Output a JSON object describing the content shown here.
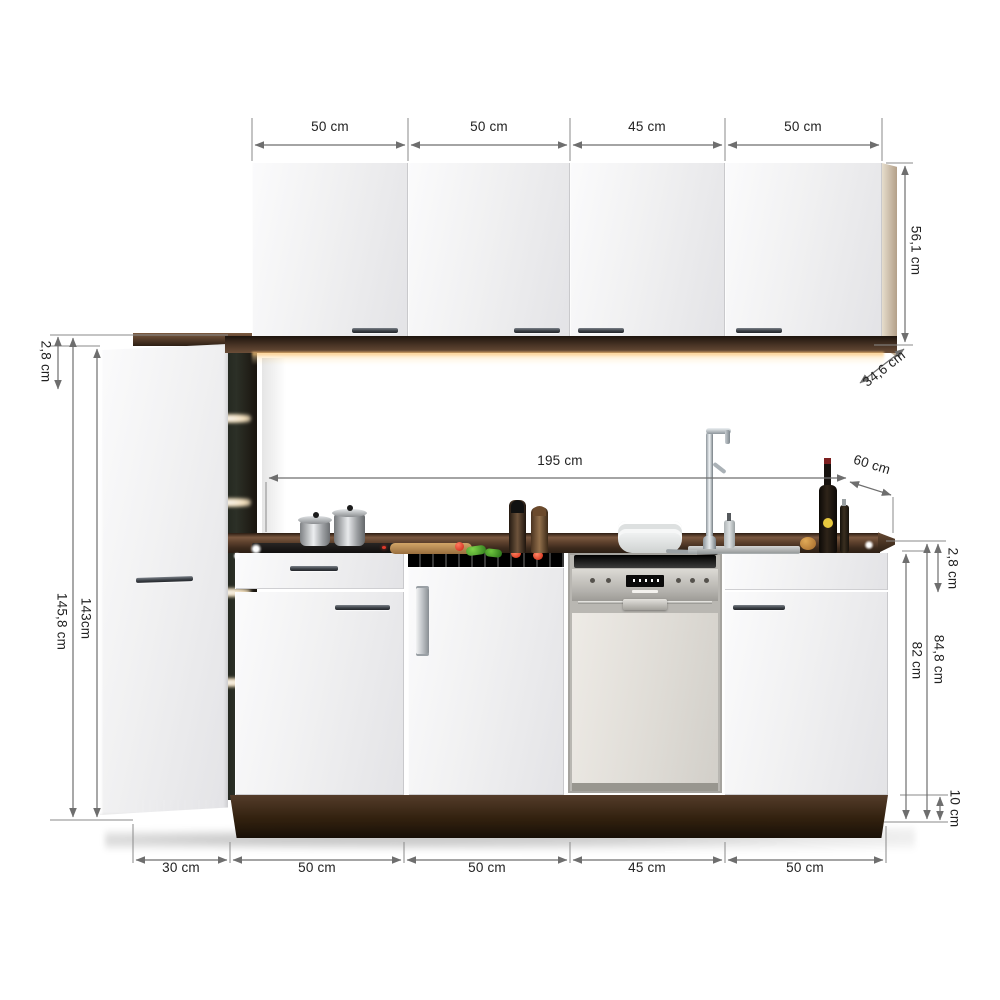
{
  "diagram": {
    "name": "kitchen-unit-dimension-diagram",
    "background": "#ffffff"
  },
  "dim_labels": {
    "top": [
      {
        "label": "50 cm"
      },
      {
        "label": "50 cm"
      },
      {
        "label": "45 cm"
      },
      {
        "label": "50 cm"
      }
    ],
    "bottom": [
      {
        "label": "30 cm"
      },
      {
        "label": "50 cm"
      },
      {
        "label": "50 cm"
      },
      {
        "label": "45 cm"
      },
      {
        "label": "50 cm"
      }
    ],
    "wall_cabinet_height": "56,1 cm",
    "wall_cabinet_depth": "34,6 cm",
    "tall_cabinet_top_offset": "2,8 cm",
    "tall_cabinet_height": "145,8 cm",
    "tall_cabinet_door_height": "143cm",
    "worktop_length": "195 cm",
    "worktop_depth": "60 cm",
    "worktop_thickness": "2,8 cm",
    "counter_height_total": "84,8 cm",
    "counter_height_base": "82 cm",
    "plinth_height": "10 cm"
  },
  "colors": {
    "wood_dark": "#3a281c",
    "cabinet_white": "#f2f2f3",
    "appliance_steel": "#b9b7b2",
    "dimension_line": "#6e6e6e",
    "label_text": "#222222",
    "under_cabinet_glow": "#f6c57c"
  }
}
